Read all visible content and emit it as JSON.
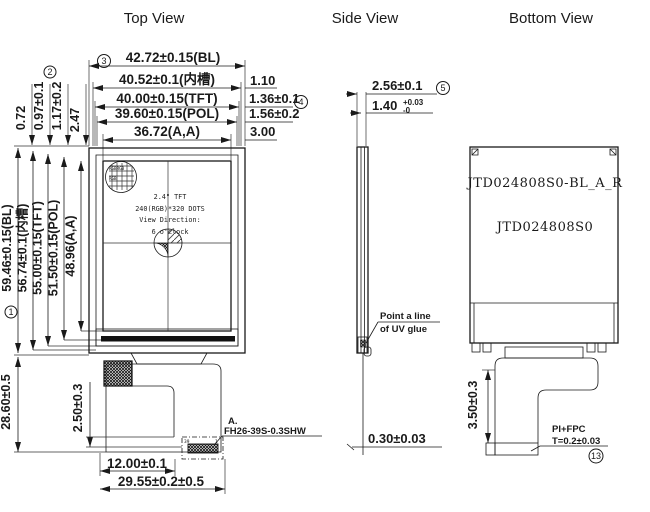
{
  "titles": {
    "top": "Top View",
    "side": "Side View",
    "bottom": "Bottom View"
  },
  "top_view": {
    "width_dims": [
      {
        "label": "42.72±0.15(BL)",
        "marker": "3"
      },
      {
        "label": "40.52±0.1(内槽)"
      },
      {
        "label": "40.00±0.15(TFT)"
      },
      {
        "label": "39.60±0.15(POL)"
      },
      {
        "label": "36.72(A,A)"
      }
    ],
    "edge_dims_right": [
      {
        "label": "1.10"
      },
      {
        "label": "1.36±0.1",
        "marker": "4"
      },
      {
        "label": "1.56±0.2"
      },
      {
        "label": "3.00"
      }
    ],
    "edge_dims_top_left": [
      {
        "label": "0.72"
      },
      {
        "label": "0.97±0.1",
        "marker": "2"
      },
      {
        "label": "1.17±0.2"
      },
      {
        "label": "2.47"
      }
    ],
    "height_dims": [
      {
        "label": "59.46±0.15(BL)",
        "marker": "1"
      },
      {
        "label": "56.74±0.1(内槽)"
      },
      {
        "label": "55.00±0.15(TFT)"
      },
      {
        "label": "51.50±0.15(POL)"
      },
      {
        "label": "48.96(A,A)"
      }
    ],
    "module_height_dim": "28.60±0.5",
    "connector_offset_dim": "2.50±0.3",
    "connector_width_dim": "12.00±0.1",
    "fpc_width_dim": "29.55±0.2±0.5",
    "connector_callout": {
      "ref": "A.",
      "part": "FH26-39S-0.3SHW"
    },
    "connector_pins": {
      "first": "39",
      "last": "1"
    },
    "panel_text": {
      "line1": "2.4\" TFT",
      "line2": "240(RGB)*320 DOTS",
      "line3": "View Direction:",
      "line4": "6 o'clock"
    },
    "pixel_detail": {
      "row1": "RGBRGB",
      "row2": "RGB"
    }
  },
  "side_view": {
    "total_thickness_dim": {
      "label": "2.56±0.1",
      "marker": "5"
    },
    "glass_thickness_dim": {
      "value": "1.40",
      "tol_plus": "+0.03",
      "tol_minus": "-0"
    },
    "glue_note": {
      "line1": "Point a line",
      "line2": "of UV glue"
    },
    "fpc_thickness_dim": "0.30±0.03"
  },
  "bottom_view": {
    "part_numbers": {
      "line1": "JTD024808S0-BL_A_R",
      "line2": "JTD024808S0"
    },
    "fpc_length_dim": "3.50±0.3",
    "fpc_note": {
      "line1": "PI+FPC",
      "line2": "T=0.2±0.03",
      "marker": "13"
    }
  }
}
